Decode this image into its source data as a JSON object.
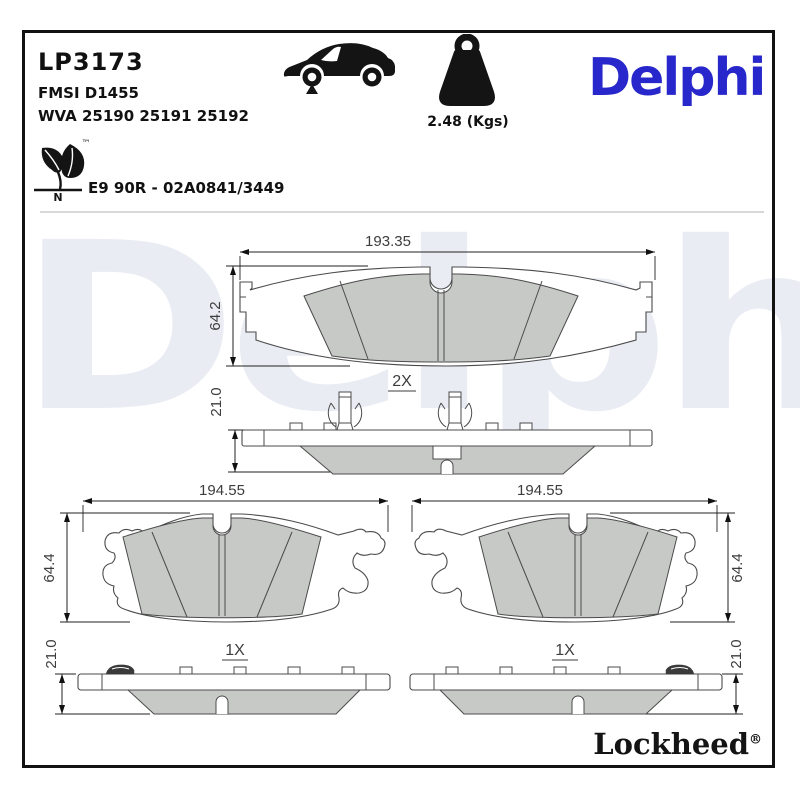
{
  "header": {
    "part_number": "LP3173",
    "fmsi": "FMSI D1455",
    "wva": "WVA 25190 25191 25192",
    "weight_label": "2.48 (Kgs)",
    "brand_logo": "Delphi",
    "eco_tm": "™",
    "eco_n": "N",
    "approval": "E9 90R - 02A0841/3449"
  },
  "watermark": "Delphi",
  "drawings": {
    "top_pad": {
      "width": "193.35",
      "height": "64.2",
      "thickness": "21.0",
      "quantity": "2X"
    },
    "bottom_left_pad": {
      "width": "194.55",
      "height": "64.4",
      "thickness": "21.0",
      "quantity": "1X"
    },
    "bottom_right_pad": {
      "width": "194.55",
      "height": "64.4",
      "thickness": "21.0",
      "quantity": "1X"
    }
  },
  "footer": {
    "brand": "Lockheed",
    "registered": "®"
  },
  "icons": {
    "vehicle": "car-front-axle-icon",
    "mass": "weight-icon",
    "eco": "leaf-icon"
  },
  "colors": {
    "brand_blue": "#2727cb",
    "watermark_gray": "#e9ecf3",
    "friction_gray": "#c7c9c7",
    "line_dark": "#4b4b4b",
    "border_black": "#121212"
  }
}
